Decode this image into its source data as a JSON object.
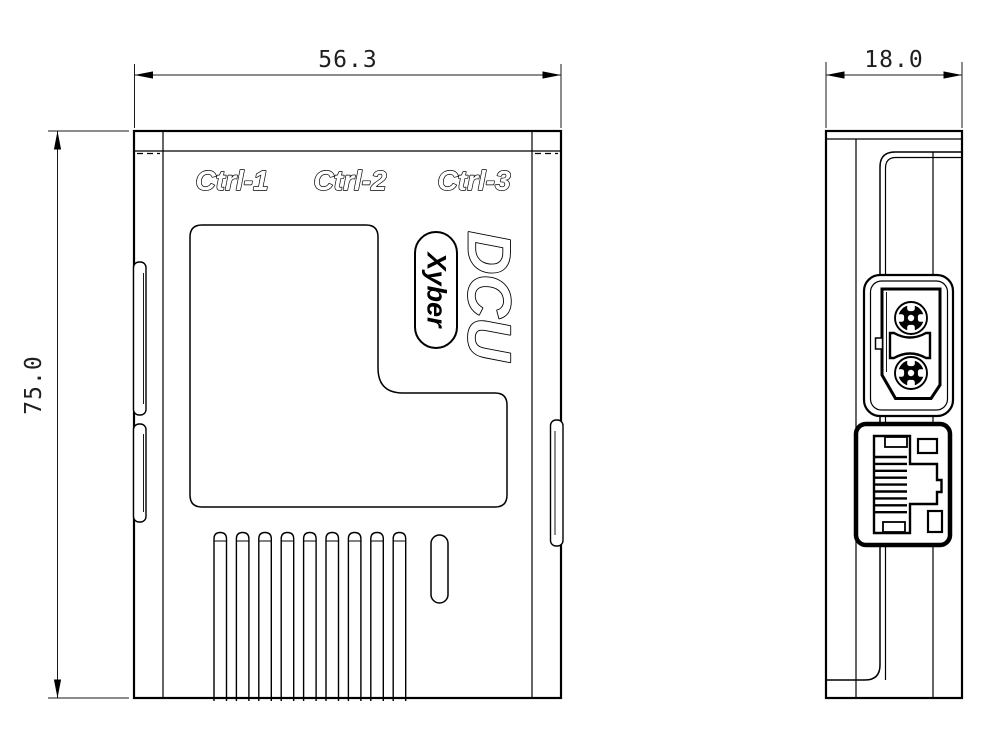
{
  "drawing": {
    "background": "#ffffff",
    "line_color": "#000000",
    "front_view": {
      "port_labels": [
        "Ctrl-1",
        "Ctrl-2",
        "Ctrl-3"
      ],
      "product_name": "DCU",
      "brand": "Xyber",
      "width_dim": "56.3",
      "height_dim": "75.0"
    },
    "side_view": {
      "depth_dim": "18.0",
      "connectors": [
        "xt30-power-connector",
        "rj45-ethernet-port"
      ]
    }
  }
}
